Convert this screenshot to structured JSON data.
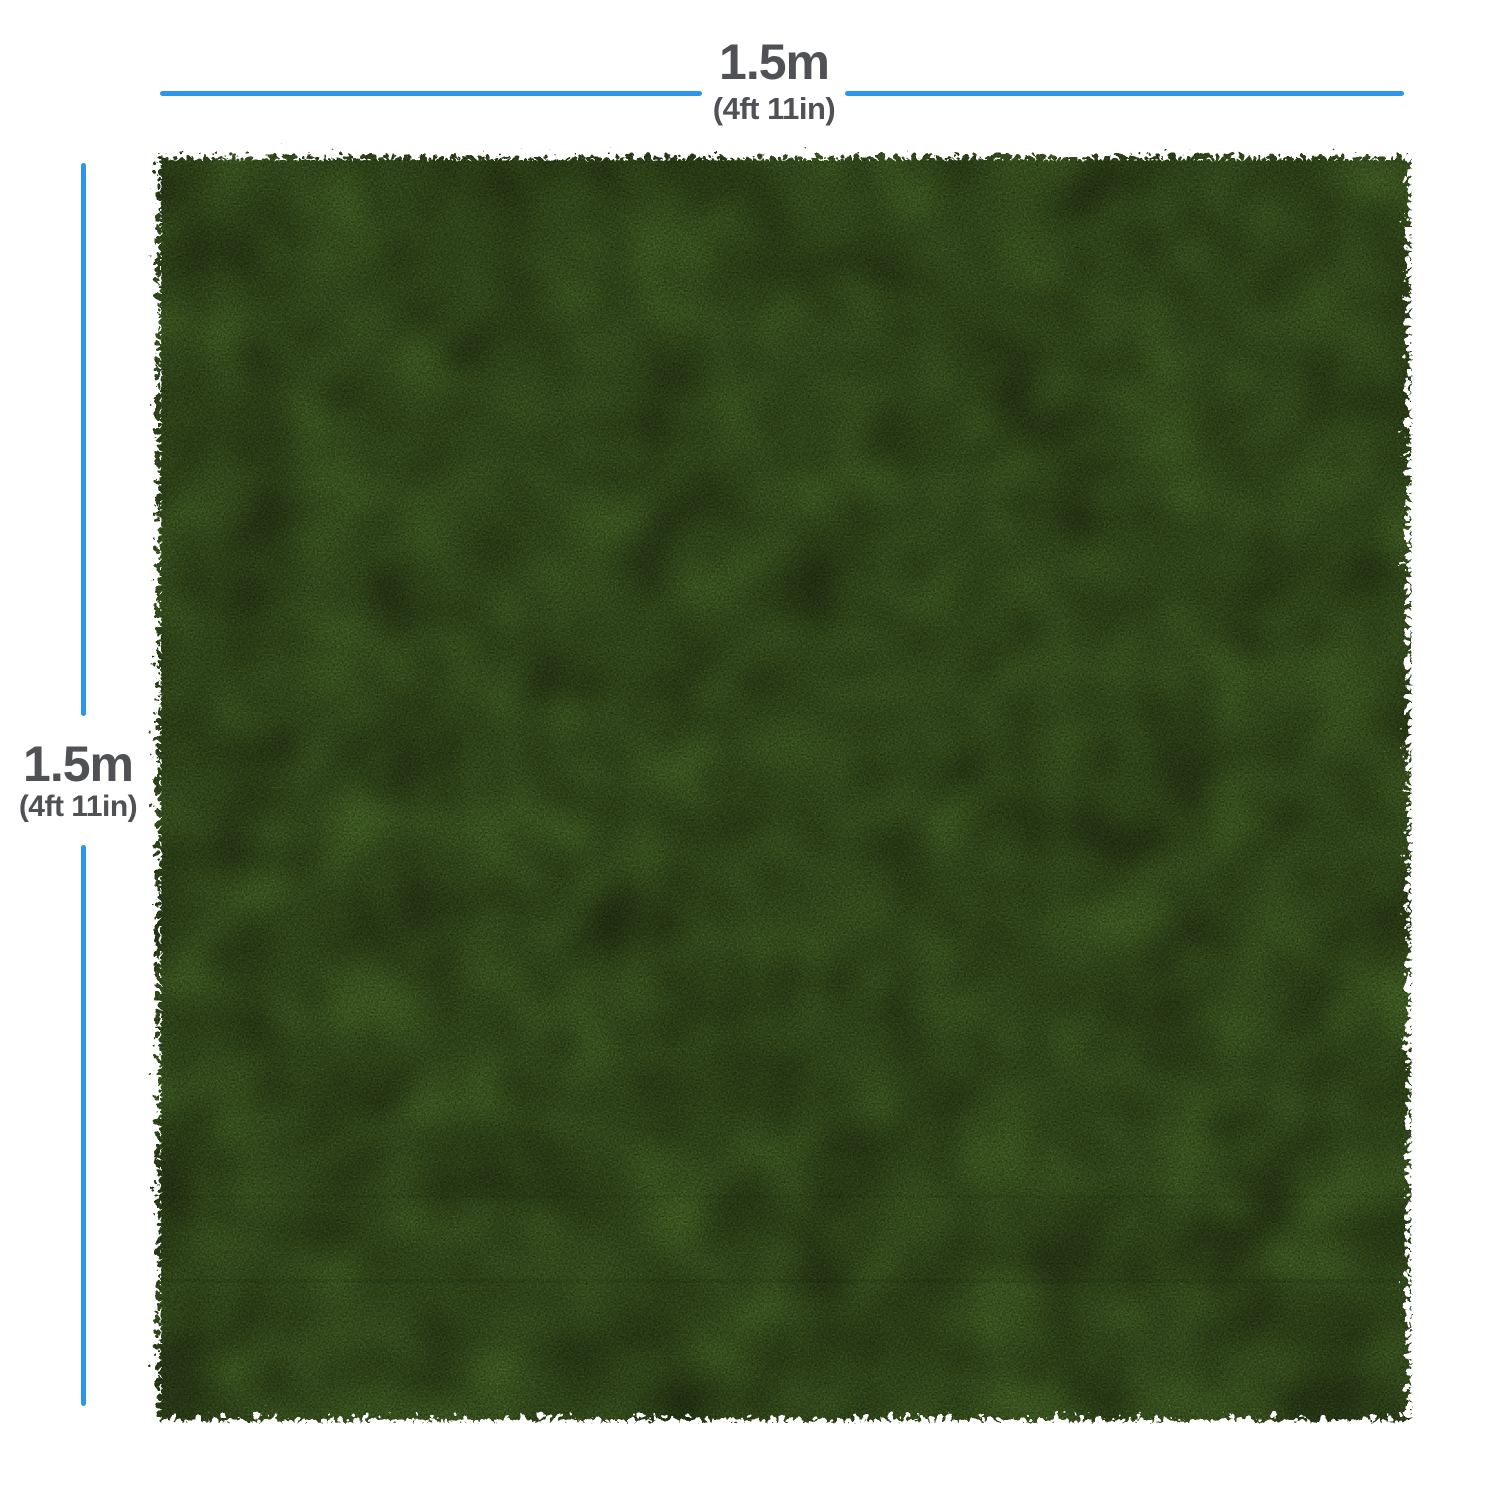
{
  "annotations": {
    "width": {
      "metric": "1.5m",
      "imperial": "(4ft 11in)"
    },
    "height": {
      "metric": "1.5m",
      "imperial": "(4ft 11in)"
    }
  },
  "theme": {
    "background": "#ffffff",
    "dimension_line_color": "#2e96e9",
    "label_color": "#505154",
    "grass_base": "#4a6530",
    "grass_dark": "#273c17",
    "grass_light": "#7f9c4e"
  }
}
